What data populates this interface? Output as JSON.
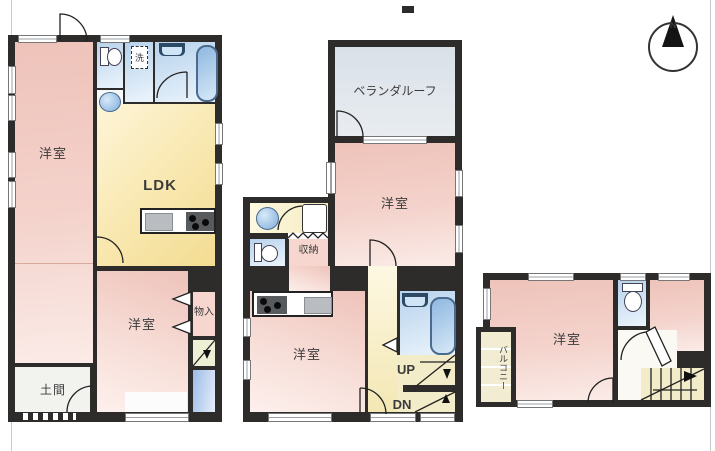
{
  "floorplan": {
    "compass_n": "N",
    "f1": {
      "yoshitsu_a": "洋室",
      "ldk": "LDK",
      "yoshitsu_b": "洋室",
      "doma": "土間",
      "monoire": "物入",
      "laundry": "洗"
    },
    "f2": {
      "veranda": "ベランダルーフ",
      "yoshitsu_a": "洋室",
      "shunou": "収納",
      "yoshitsu_b": "洋室",
      "up": "UP",
      "dn": "DN"
    },
    "f3": {
      "yoshitsu": "洋室",
      "balcony": "バルコニー"
    },
    "colors": {
      "wall": "#2e2b2b",
      "room_pink": "#f2cdc5",
      "wet_blue": "#bcd6ee",
      "ldk_yellow": "#f5df96",
      "veranda_gray": "#dbe2e9",
      "stair_yellow": "#f3ecc8",
      "balcony_tan": "#f1ecd2"
    }
  }
}
